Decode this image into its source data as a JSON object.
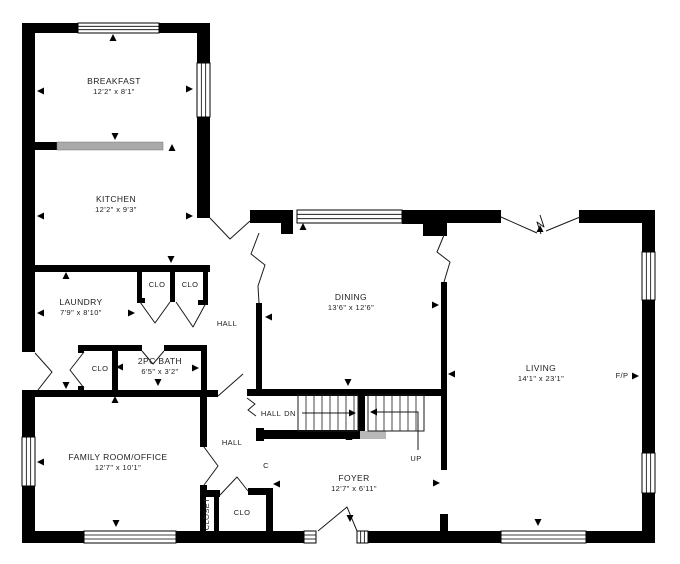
{
  "document": {
    "type": "residential-floor-plan",
    "level": "main-floor"
  },
  "canvas": {
    "width": 680,
    "height": 564,
    "background": "#ffffff",
    "wall_color": "#000000",
    "line_color": "#1a1a1a",
    "counter_color": "#a9a9a9",
    "landing_color": "#b8b8b8",
    "text_color": "#1c1c1c"
  },
  "rooms": [
    {
      "id": "breakfast",
      "name": "BREAKFAST",
      "dims": "12'2\" x 8'1\"",
      "label_x": 114,
      "label_y": 84
    },
    {
      "id": "kitchen",
      "name": "KITCHEN",
      "dims": "12'2\" x 9'3\"",
      "label_x": 116,
      "label_y": 202
    },
    {
      "id": "laundry",
      "name": "LAUNDRY",
      "dims": "7'9\" x 8'10\"",
      "label_x": 81,
      "label_y": 305
    },
    {
      "id": "bath",
      "name": "2PC BATH",
      "dims": "6'5\" x 3'2\"",
      "label_x": 160,
      "label_y": 364
    },
    {
      "id": "dining",
      "name": "DINING",
      "dims": "13'6\" x 12'6\"",
      "label_x": 351,
      "label_y": 300
    },
    {
      "id": "living",
      "name": "LIVING",
      "dims": "14'1\" x 23'1\"",
      "label_x": 541,
      "label_y": 371
    },
    {
      "id": "family-room",
      "name": "FAMILY ROOM/OFFICE",
      "dims": "12'7\" x 10'1\"",
      "label_x": 118,
      "label_y": 460
    },
    {
      "id": "foyer",
      "name": "FOYER",
      "dims": "12'7\" x 6'11\"",
      "label_x": 354,
      "label_y": 481
    }
  ],
  "labels": [
    {
      "id": "clo-hall-left",
      "text": "CLO",
      "x": 157,
      "y": 287
    },
    {
      "id": "clo-hall-right",
      "text": "CLO",
      "x": 190,
      "y": 287
    },
    {
      "id": "hall-upper",
      "text": "HALL",
      "x": 227,
      "y": 326
    },
    {
      "id": "clo-bath",
      "text": "CLO",
      "x": 100,
      "y": 371
    },
    {
      "id": "hall-stair",
      "text": "HALL",
      "x": 271,
      "y": 416
    },
    {
      "id": "stairs-down",
      "text": "DN",
      "x": 290,
      "y": 416
    },
    {
      "id": "hall-lower",
      "text": "HALL",
      "x": 232,
      "y": 445
    },
    {
      "id": "closet-c",
      "text": "C",
      "x": 266,
      "y": 468
    },
    {
      "id": "stairs-up",
      "text": "UP",
      "x": 416,
      "y": 461
    },
    {
      "id": "clo-foyer",
      "text": "CLO",
      "x": 242,
      "y": 515
    },
    {
      "id": "closet-vertical",
      "text": "CLOSET",
      "x": 209,
      "y": 514,
      "rotate": -90
    },
    {
      "id": "fireplace",
      "text": "F/P",
      "x": 622,
      "y": 378
    }
  ],
  "walls": [
    [
      22,
      23,
      56,
      10
    ],
    [
      159,
      23,
      51,
      10
    ],
    [
      22,
      23,
      13,
      329
    ],
    [
      22,
      390,
      13,
      47
    ],
    [
      22,
      486,
      13,
      57
    ],
    [
      22,
      531,
      62,
      12
    ],
    [
      176,
      531,
      128,
      12
    ],
    [
      368,
      531,
      133,
      12
    ],
    [
      586,
      531,
      69,
      12
    ],
    [
      642,
      210,
      13,
      42
    ],
    [
      642,
      300,
      13,
      153
    ],
    [
      642,
      493,
      13,
      50
    ],
    [
      579,
      210,
      76,
      13
    ],
    [
      443,
      210,
      58,
      13
    ],
    [
      402,
      210,
      45,
      14
    ],
    [
      423,
      224,
      24,
      12
    ],
    [
      250,
      210,
      43,
      13
    ],
    [
      281,
      223,
      12,
      11
    ],
    [
      197,
      23,
      13,
      40
    ],
    [
      197,
      117,
      13,
      101
    ],
    [
      33,
      265,
      177,
      7
    ],
    [
      137,
      272,
      5,
      30
    ],
    [
      170,
      272,
      5,
      30
    ],
    [
      203,
      272,
      5,
      30
    ],
    [
      137,
      298,
      8,
      5
    ],
    [
      198,
      300,
      10,
      5
    ],
    [
      78,
      345,
      64,
      6
    ],
    [
      164,
      345,
      43,
      6
    ],
    [
      78,
      345,
      6,
      8
    ],
    [
      78,
      386,
      6,
      11
    ],
    [
      112,
      345,
      6,
      52
    ],
    [
      201,
      345,
      6,
      52
    ],
    [
      22,
      390,
      196,
      7
    ],
    [
      247,
      389,
      200,
      7
    ],
    [
      256,
      303,
      6,
      92
    ],
    [
      200,
      397,
      7,
      50
    ],
    [
      200,
      485,
      7,
      12
    ],
    [
      200,
      490,
      20,
      7
    ],
    [
      200,
      497,
      6,
      34
    ],
    [
      214,
      497,
      5,
      34
    ],
    [
      248,
      488,
      24,
      7
    ],
    [
      266,
      488,
      7,
      43
    ],
    [
      358,
      395,
      7,
      38
    ],
    [
      256,
      428,
      8,
      13
    ],
    [
      256,
      430,
      104,
      9
    ],
    [
      441,
      282,
      6,
      188
    ],
    [
      440,
      514,
      8,
      17
    ]
  ],
  "windows": [
    [
      78,
      23,
      81,
      10
    ],
    [
      197,
      63,
      13,
      54
    ],
    [
      297,
      210,
      105,
      13
    ],
    [
      642,
      252,
      13,
      48
    ],
    [
      642,
      453,
      13,
      40
    ],
    [
      501,
      531,
      85,
      12
    ],
    [
      84,
      531,
      92,
      12
    ],
    [
      22,
      437,
      13,
      49
    ],
    [
      304,
      531,
      12,
      12
    ],
    [
      357,
      531,
      11,
      12
    ]
  ],
  "doors": [
    {
      "id": "side-entry-door",
      "points": [
        [
          35,
          353
        ],
        [
          52,
          372
        ],
        [
          38,
          390
        ]
      ]
    },
    {
      "id": "kitchen-hall-door",
      "points": [
        [
          210,
          218
        ],
        [
          230,
          239
        ],
        [
          250,
          221
        ]
      ]
    },
    {
      "id": "family-hall-door",
      "points": [
        [
          204,
          447
        ],
        [
          218,
          466
        ],
        [
          204,
          485
        ]
      ]
    },
    {
      "id": "clo-left-door",
      "points": [
        [
          140,
          302
        ],
        [
          155,
          323
        ],
        [
          170,
          302
        ]
      ]
    },
    {
      "id": "clo-right-door",
      "points": [
        [
          176,
          302
        ],
        [
          193,
          327
        ],
        [
          206,
          303
        ]
      ]
    },
    {
      "id": "bath-door",
      "points": [
        [
          142,
          351
        ],
        [
          153,
          364
        ],
        [
          164,
          351
        ]
      ]
    },
    {
      "id": "bath-clo-door",
      "points": [
        [
          84,
          352
        ],
        [
          70,
          370
        ],
        [
          84,
          388
        ]
      ]
    },
    {
      "id": "front-entry-door",
      "points": [
        [
          318,
          531
        ],
        [
          347,
          507
        ],
        [
          357,
          531
        ]
      ]
    },
    {
      "id": "foyer-clo-door",
      "points": [
        [
          220,
          495
        ],
        [
          237,
          477
        ],
        [
          248,
          491
        ]
      ]
    },
    {
      "id": "hall-stair-door-leaf",
      "points": [
        [
          218,
          396
        ],
        [
          243,
          374
        ]
      ]
    }
  ],
  "openings": [
    {
      "id": "dining-west-opening",
      "points": [
        [
          259,
          233
        ],
        [
          251,
          254
        ],
        [
          265,
          265
        ],
        [
          258,
          286
        ],
        [
          259,
          303
        ]
      ]
    },
    {
      "id": "dining-east-opening",
      "points": [
        [
          444,
          235
        ],
        [
          437,
          252
        ],
        [
          450,
          262
        ],
        [
          444,
          282
        ]
      ]
    },
    {
      "id": "living-top-opening-left",
      "points": [
        [
          501,
          217
        ],
        [
          537,
          233
        ]
      ]
    },
    {
      "id": "living-top-opening-right",
      "points": [
        [
          580,
          217
        ],
        [
          546,
          231
        ]
      ]
    },
    {
      "id": "living-top-opening-break",
      "points": [
        [
          541,
          234
        ],
        [
          537,
          222
        ],
        [
          544,
          227
        ],
        [
          540,
          215
        ]
      ]
    },
    {
      "id": "hall-stair-opening",
      "points": [
        [
          247,
          398
        ],
        [
          255,
          404
        ],
        [
          248,
          410
        ],
        [
          256,
          416
        ]
      ]
    }
  ],
  "stairs": {
    "down_box": [
      298,
      395,
      60,
      36
    ],
    "up_box": [
      368,
      395,
      56,
      36
    ],
    "tread_step": 8,
    "down_arrow": [
      [
        302,
        413
      ],
      [
        350,
        413
      ]
    ],
    "up_arrow": [
      [
        376,
        412
      ],
      [
        418,
        412
      ],
      [
        418,
        450
      ]
    ],
    "landing": [
      360,
      431,
      26,
      8
    ]
  },
  "counter": {
    "stub": [
      35,
      142,
      22,
      8
    ],
    "bar": [
      57,
      142,
      106,
      8
    ]
  },
  "markers": [
    [
      113,
      38,
      "up"
    ],
    [
      41,
      91,
      "left"
    ],
    [
      189,
      89,
      "right"
    ],
    [
      115,
      136,
      "down"
    ],
    [
      172,
      148,
      "up"
    ],
    [
      41,
      216,
      "left"
    ],
    [
      189,
      216,
      "right"
    ],
    [
      171,
      259,
      "down"
    ],
    [
      66,
      276,
      "up"
    ],
    [
      41,
      313,
      "left"
    ],
    [
      131,
      313,
      "right"
    ],
    [
      120,
      367,
      "left"
    ],
    [
      195,
      368,
      "right"
    ],
    [
      158,
      382,
      "down"
    ],
    [
      115,
      400,
      "up"
    ],
    [
      66,
      385,
      "down"
    ],
    [
      41,
      462,
      "left"
    ],
    [
      116,
      523,
      "down"
    ],
    [
      303,
      227,
      "up"
    ],
    [
      269,
      317,
      "left"
    ],
    [
      435,
      305,
      "right"
    ],
    [
      348,
      382,
      "down"
    ],
    [
      349,
      437,
      "up"
    ],
    [
      540,
      229,
      "up"
    ],
    [
      452,
      374,
      "left"
    ],
    [
      635,
      376,
      "right"
    ],
    [
      538,
      522,
      "down"
    ],
    [
      277,
      484,
      "left"
    ],
    [
      436,
      483,
      "right"
    ],
    [
      352,
      413,
      "right"
    ],
    [
      374,
      412,
      "left"
    ],
    [
      350,
      518,
      "down"
    ]
  ]
}
